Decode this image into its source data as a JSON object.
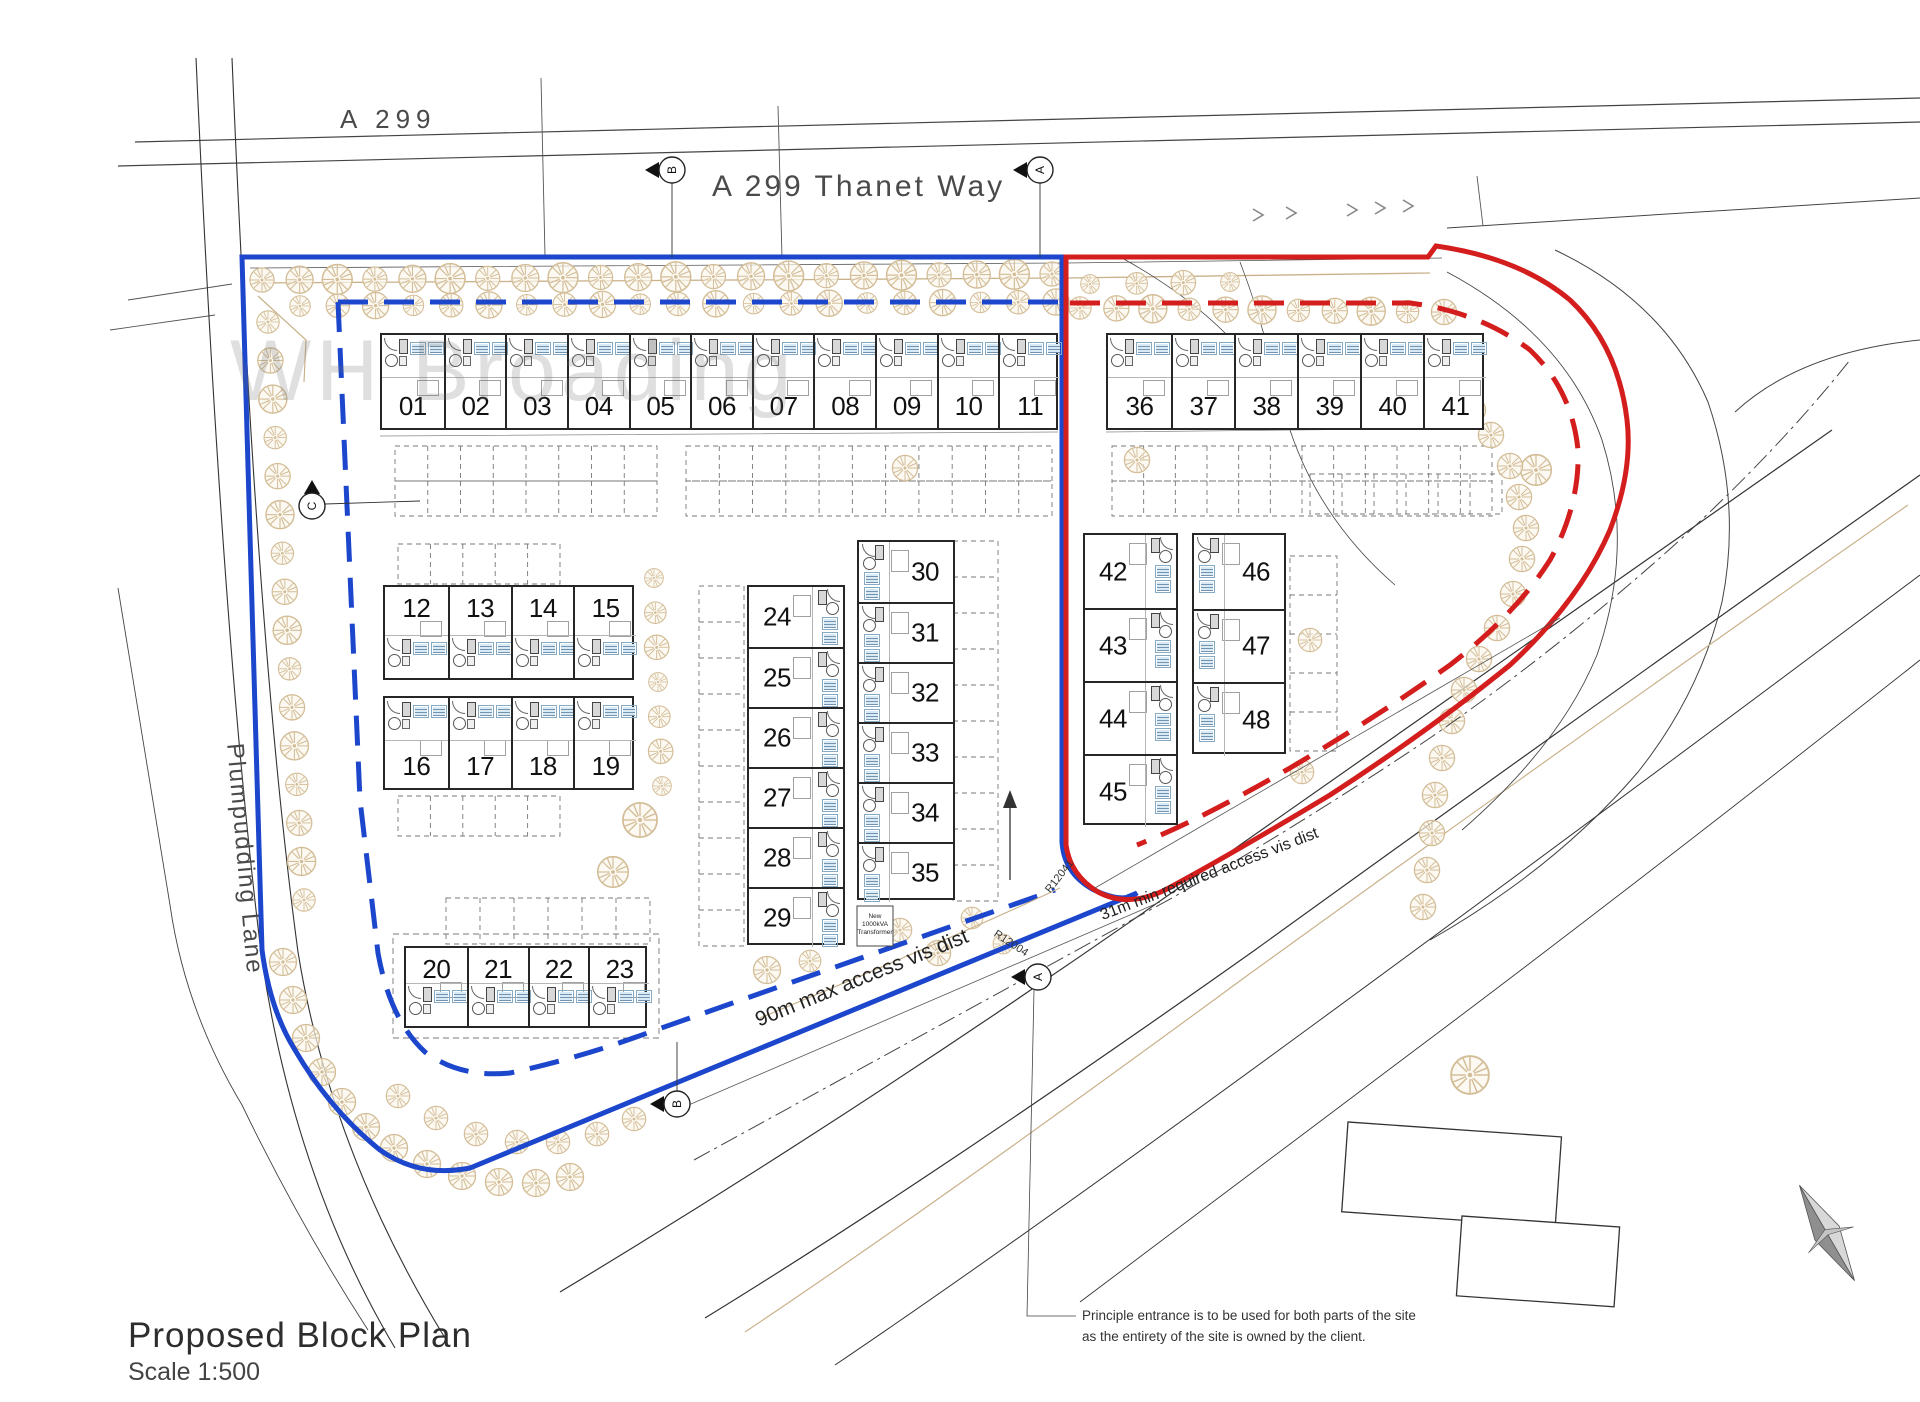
{
  "title": {
    "name": "Proposed Block Plan",
    "scale": "Scale 1:500"
  },
  "watermark": "WH Broading",
  "roads": {
    "a299": "A 299",
    "thanet_way": "A 299 Thanet Way",
    "plumpudding_lane": "Plumpudding Lane"
  },
  "annotations": {
    "vis_blue": "90m max access vis dist",
    "vis_red": "31m min required access vis dist",
    "radius_upper": "R12041",
    "radius_lower": "R12004",
    "note_line1": "Principle entrance is to be used for both parts of the site",
    "note_line2": "as the entirety of the site is owned by the client.",
    "transformer_line1": "New",
    "transformer_line2": "1000kVA",
    "transformer_line3": "Transformer"
  },
  "markers": {
    "top_left": "B",
    "top_right": "A",
    "left": "C",
    "entrance": "A",
    "access": "B"
  },
  "unit_groups": {
    "row_top_left": [
      "01",
      "02",
      "03",
      "04",
      "05",
      "06",
      "07",
      "08",
      "09",
      "10",
      "11"
    ],
    "row_top_right": [
      "36",
      "37",
      "38",
      "39",
      "40",
      "41"
    ],
    "block_mid_upper": [
      "12",
      "13",
      "14",
      "15"
    ],
    "block_mid_lower": [
      "16",
      "17",
      "18",
      "19"
    ],
    "block_bottom": [
      "20",
      "21",
      "22",
      "23"
    ],
    "col_inner_west": [
      "24",
      "25",
      "26",
      "27",
      "28",
      "29"
    ],
    "col_inner_east": [
      "30",
      "31",
      "32",
      "33",
      "34",
      "35"
    ],
    "col_east_a": [
      "42",
      "43",
      "44",
      "45"
    ],
    "col_east_b": [
      "46",
      "47",
      "48"
    ]
  },
  "colors": {
    "site_boundary_blue": "#1c46cc",
    "site_boundary_red": "#d41e1e",
    "tree_outline": "#d3bd97",
    "unit_label_fill": "#d8eaf5"
  }
}
